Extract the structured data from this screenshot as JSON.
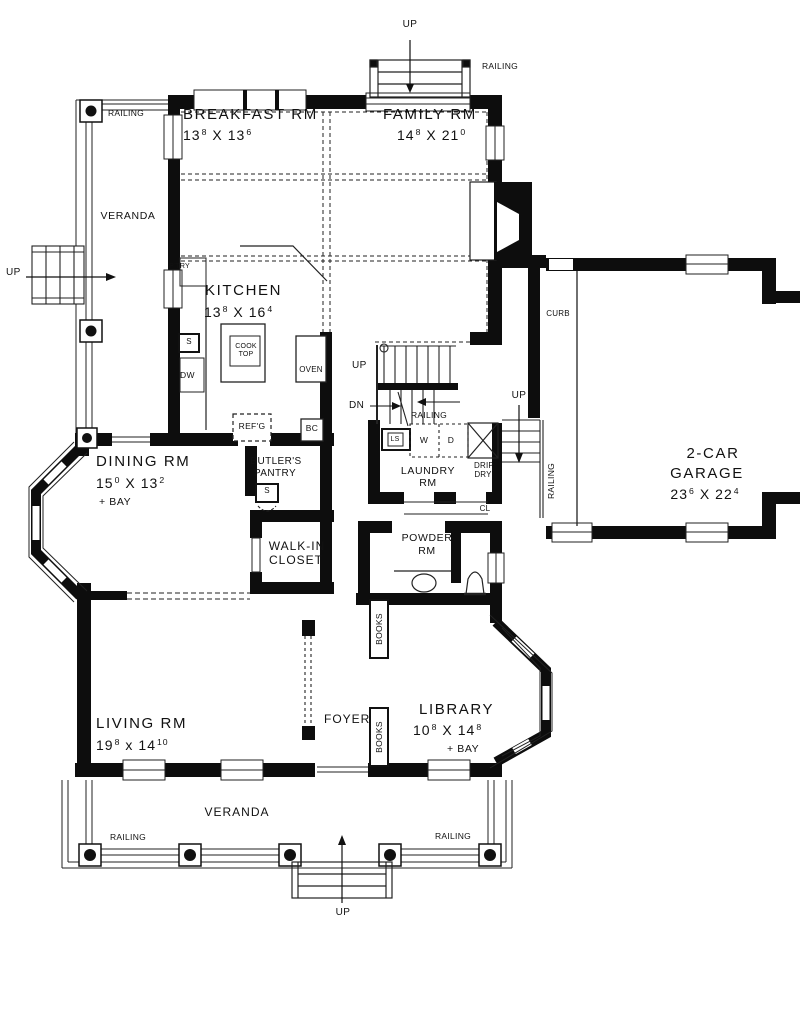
{
  "rooms": {
    "breakfast": {
      "name": "BREAKFAST RM",
      "dims": {
        "a": "13",
        "a_sup": "8",
        "x": "X",
        "b": "13",
        "b_sup": "6"
      }
    },
    "family": {
      "name": "FAMILY RM",
      "dims": {
        "a": "14",
        "a_sup": "8",
        "x": "X",
        "b": "21",
        "b_sup": "0"
      }
    },
    "kitchen": {
      "name": "KITCHEN",
      "dims": {
        "a": "13",
        "a_sup": "8",
        "x": "X",
        "b": "16",
        "b_sup": "4"
      }
    },
    "dining": {
      "name": "DINING RM",
      "dims": {
        "a": "15",
        "a_sup": "0",
        "x": "X",
        "b": "13",
        "b_sup": "2"
      },
      "note": "+ BAY"
    },
    "garage": {
      "name_line1": "2-CAR",
      "name_line2": "GARAGE",
      "dims": {
        "a": "23",
        "a_sup": "6",
        "x": "X",
        "b": "22",
        "b_sup": "4"
      }
    },
    "laundry": {
      "name_line1": "LAUNDRY",
      "name_line2": "RM"
    },
    "powder": {
      "name_line1": "POWDER",
      "name_line2": "RM"
    },
    "butlers_pantry": {
      "name_line1": "BUTLER'S",
      "name_line2": "PANTRY"
    },
    "walk_in_closet": {
      "name_line1": "WALK-IN",
      "name_line2": "CLOSET"
    },
    "living": {
      "name": "LIVING RM",
      "dims": {
        "a": "19",
        "a_sup": "8",
        "x": "x",
        "b": "14",
        "b_sup": "10"
      }
    },
    "foyer": {
      "name": "FOYER"
    },
    "library": {
      "name": "LIBRARY",
      "dims": {
        "a": "10",
        "a_sup": "8",
        "x": "X",
        "b": "14",
        "b_sup": "8"
      },
      "note": "+ BAY"
    },
    "veranda_left": {
      "name": "VERANDA"
    },
    "veranda_front": {
      "name": "VERANDA"
    }
  },
  "annotations": {
    "up": "UP",
    "dn": "DN",
    "railing": "RAILING",
    "curb": "CURB",
    "pantry": "P'TRY",
    "sink": "S",
    "dishwasher": "DW",
    "cooktop_line1": "COOK",
    "cooktop_line2": "TOP",
    "oven": "OVEN",
    "refrigerator": "REF'G",
    "bar_cabinet": "BC",
    "laundry_sink": "LS",
    "washer": "W",
    "dryer": "D",
    "drip_dry_line1": "DRIP",
    "drip_dry_line2": "DRY",
    "closet": "CL",
    "books": "BOOKS"
  },
  "colors": {
    "background": "#ffffff",
    "wall": "#0d0d0d",
    "line": "#222222",
    "text": "#111111"
  }
}
